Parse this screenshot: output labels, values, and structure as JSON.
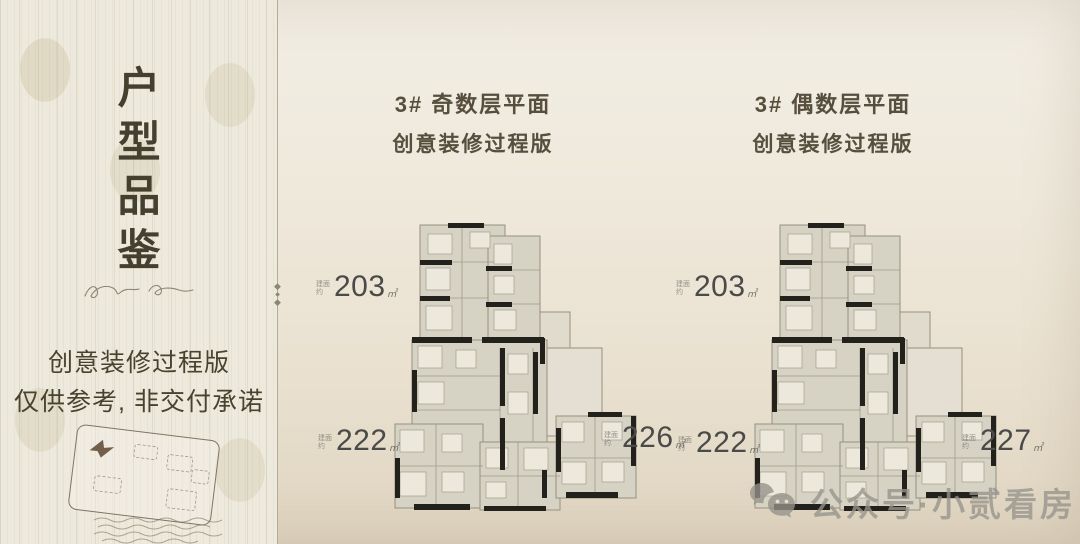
{
  "sidebar": {
    "vertical_title_chars": [
      "户",
      "型",
      "品",
      "鉴"
    ],
    "disclaimer_line1": "创意装修过程版",
    "disclaimer_line2": "仅供参考, 非交付承诺"
  },
  "plans": [
    {
      "title_line1": "3# 奇数层平面",
      "title_line2": "创意装修过程版",
      "areas": [
        {
          "prefix": "建面约",
          "value": "203",
          "unit": "㎡"
        },
        {
          "prefix": "建面约",
          "value": "222",
          "unit": "㎡"
        },
        {
          "prefix": "建面约",
          "value": "226",
          "unit": "㎡"
        }
      ]
    },
    {
      "title_line1": "3# 偶数层平面",
      "title_line2": "创意装修过程版",
      "areas": [
        {
          "prefix": "建面约",
          "value": "203",
          "unit": "㎡"
        },
        {
          "prefix": "建面约",
          "value": "222",
          "unit": "㎡"
        },
        {
          "prefix": "建面约",
          "value": "227",
          "unit": "㎡"
        }
      ]
    }
  ],
  "watermark": {
    "icon": "wechat-icon",
    "text": "公众号·小贰看房"
  },
  "colors": {
    "background_beige": "#ece5d6",
    "sidebar_cream": "#edeadd",
    "title_brown": "#564f3e",
    "wall_black": "#23211c",
    "room_gray": "#d6d2c4",
    "watermark_gray": "#97948d"
  }
}
